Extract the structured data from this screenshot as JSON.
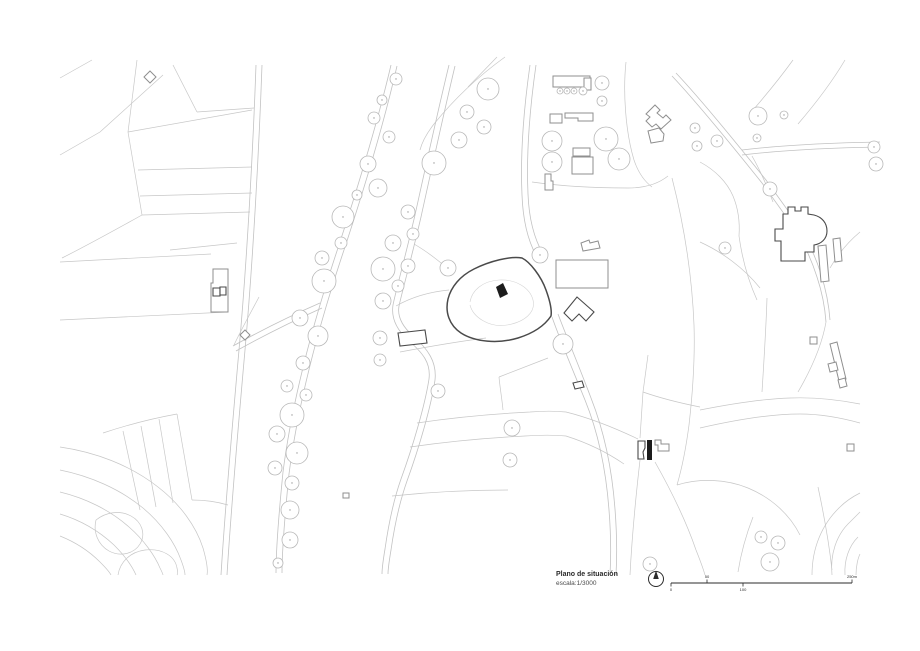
{
  "title_block": {
    "title": "Plano de situación",
    "scale": "escala:1/3000"
  },
  "scale_bar": {
    "x_start": 671,
    "x_end": 852,
    "y": 583,
    "ticks": [
      {
        "label": "0",
        "x": 671,
        "side": "below"
      },
      {
        "label": "50",
        "x": 707,
        "side": "above"
      },
      {
        "label": "100",
        "x": 743,
        "side": "below"
      },
      {
        "label": "250m",
        "x": 852,
        "side": "above"
      }
    ]
  },
  "north_arrow": {
    "cx": 656,
    "cy": 579,
    "r": 7.5
  },
  "colors": {
    "field_line": "#c7c7c7",
    "road": "#c2c2c2",
    "tree": "#b8b8b8",
    "tree_dot": "#9a9a9a",
    "building": "#8f8f8f",
    "dark": "#4a4a4a",
    "fill": "#1c1c1c",
    "ink": "#2b2b2b"
  },
  "map": {
    "field_lines": [
      "M 60 78 L 92 60",
      "M 60 155 L 100 132 L 163 75",
      "M 137 60 L 128 132",
      "M 128 132 L 252 110",
      "M 173 65 L 197 112",
      "M 197 112 L 254 108",
      "M 128 132 L 142 215",
      "M 138 170 L 252 167",
      "M 140 196 L 252 193",
      "M 142 215 L 250 212",
      "M 142 215 C 115 230 88 245 62 258",
      "M 60 262 L 211 254",
      "M 60 320 L 228 312",
      "M 170 250 L 237 243",
      "M 103 433 C 130 424 155 418 177 414",
      "M 177 414 L 192 500",
      "M 159 419 L 173 503",
      "M 141 426 L 156 507",
      "M 123 431 L 140 510",
      "M 192 500 C 206 500 218 502 228 505",
      "M 259 297 C 250 314 241 330 234 345",
      "M 505 57 C 480 75 455 98 434 124 C 427 133 422 142 420 150",
      "M 468 87 L 497 57",
      "M 532 182 C 560 186 595 188 628 188 C 645 188 658 184 668 176",
      "M 626 62 C 623 90 625 130 634 160 C 638 172 644 181 652 187",
      "M 672 178 C 684 225 692 275 694 325 C 695 355 693 390 689 425 C 686 448 682 468 677 485",
      "M 648 355 L 643 392 L 640 438",
      "M 643 392 C 660 398 680 403 700 407",
      "M 640 460 C 636 495 632 535 630 575",
      "M 655 462 C 668 485 684 515 696 550 C 700 560 703 568 705 575",
      "M 767 298 C 766 330 764 360 762 392",
      "M 700 410 C 730 404 760 399 790 398 C 815 397 840 400 860 404",
      "M 700 428 C 735 420 770 414 800 414 C 822 414 842 418 860 423",
      "M 826 322 C 822 345 812 368 798 392",
      "M 752 156 C 760 170 767 186 773 202",
      "M 700 162 C 715 170 727 182 733 196 C 738 208 740 222 739 236",
      "M 739 236 C 742 258 748 280 757 300",
      "M 700 242 C 722 252 744 268 760 288",
      "M 793 60 C 780 78 766 95 753 110",
      "M 845 60 C 832 82 816 103 798 124",
      "M 860 232 C 848 242 838 254 830 268",
      "M 417 423 C 450 418 490 414 530 412 C 542 411 556 411 566 412",
      "M 410 447 C 445 442 485 438 525 436 C 540 435 555 435 566 436",
      "M 392 496 C 430 492 470 490 508 490",
      "M 548 358 C 530 365 512 372 499 377",
      "M 499 377 C 500 388 502 399 503 410",
      "M 400 352 C 432 346 462 341 486 338",
      "M 566 412 C 590 418 615 428 638 439",
      "M 566 436 C 588 443 608 453 624 464",
      "M 449 290 C 428 292 410 298 396 306",
      "M 452 272 C 440 262 428 252 414 244",
      "M 677 485 C 700 478 726 479 748 488 C 772 498 790 515 800 535",
      "M 753 517 C 746 535 741 553 738 572",
      "M 818 487 C 824 515 829 543 832 570"
    ],
    "contours": [
      "M 60 447 C 95 452 130 465 158 487 C 180 504 196 526 203 548 C 207 562 208 570 207 575",
      "M 60 470 C 90 476 120 489 143 508 C 162 524 175 543 181 560 C 184 568 185 572 185 575",
      "M 60 492 C 85 498 110 510 129 527 C 144 540 155 556 160 568 C 162 572 163 574 163 575",
      "M 60 514 C 80 520 99 531 114 545 C 124 555 132 566 136 575",
      "M 60 536 C 75 542 89 551 100 562 C 105 567 109 571 111 575",
      "M 96 520 C 106 512 120 510 131 516 C 142 522 146 534 140 544 C 134 554 120 557 109 551 C 98 545 93 532 96 520",
      "M 118 575 C 120 562 130 552 145 550 C 162 548 175 556 177 568 C 178 572 178 574 177 575",
      "M 812 575 C 812 548 822 524 840 507 C 847 500 854 496 860 493",
      "M 832 575 C 830 555 836 535 850 522 C 855 517 858 514 860 512",
      "M 845 575 C 844 560 849 546 858 537",
      "M 856 575 C 856 566 858 558 860 554"
    ],
    "roads": [
      "M 256 65 C 253 150 247 260 239 350 C 231 440 225 510 221 575",
      "M 262 65 C 259 150 253 260 245 350 C 237 440 231 510 227 575",
      "M 391 65 C 380 112 360 182 335 257 C 312 327 292 402 283 472 C 278 522 276 550 276 573",
      "M 397 66 C 386 114 366 184 341 259 C 318 329 298 404 289 474 C 284 524 282 551 282 573",
      "M 449 65 C 438 110 426 165 415 215 C 404 262 396 290 393 305 C 391 318 397 330 408 340 C 423 353 431 363 429 379 C 425 405 413 446 401 479 C 395 496 389 521 385 549 C 383 561 382 569 382 574",
      "M 455 66 C 444 112 432 167 421 217 C 410 264 402 292 399 306 C 397 317 403 327 413 336 C 428 349 437 362 435 380 C 431 407 419 448 407 481 C 401 498 395 522 391 550 C 389 562 388 569 388 574",
      "M 530 65 C 525 100 520 150 522 195 C 523 222 529 243 537 257",
      "M 536 65 C 531 100 526 150 528 194 C 529 220 535 240 543 254",
      "M 552 317 C 560 340 572 368 585 400 C 598 432 606 470 609 510 C 611 535 611 557 610 575",
      "M 558 314 C 567 338 579 366 591 398 C 604 431 612 469 615 509 C 617 535 617 557 616 575",
      "M 672 76 C 690 95 726 138 762 183 L 790 222 C 800 236 810 255 817 277 C 822 292 825 308 826 322",
      "M 676 73 C 694 92 730 135 766 180 L 794 219 C 804 233 814 252 821 274 C 826 290 829 306 830 320",
      "M 742 150 C 775 146 820 143 880 142",
      "M 742 155 C 775 151 820 148 880 147",
      "M 233 346 C 260 331 290 316 320 303",
      "M 236 351 C 263 336 293 321 322 308"
    ],
    "buildings_gray": [
      "M 553 76 L 590 76 L 590 87 L 553 87 Z",
      "M 584 78 L 591 78 L 591 90 L 584 90 Z",
      "M 550 114 L 562 114 L 562 123 L 550 123 Z",
      "M 565 113 L 593 113 L 593 121 L 578 121 L 578 118 L 565 118 Z",
      "M 573 148 L 590 148 L 590 156 L 573 156 Z",
      "M 572 157 L 593 157 L 593 174 L 572 174 Z",
      "M 545 174 L 551 174 L 551 181 L 553 181 L 553 190 L 545 190 Z",
      "M 556 260 L 608 260 L 608 288 L 556 288 Z",
      "M 581 243 L 589 240 L 590 243 L 598 241 L 600 248 L 583 251 Z",
      "M 646 114 L 655 105 L 660 110 L 657 113 L 663 118 L 666 115 L 671 120 L 661 129 L 656 124 L 652 127 L 646 121 L 650 117 Z",
      "M 648 131 L 659 128 L 664 134 L 663 141 L 651 143 Z",
      "M 818 246 L 826 245 L 829 281 L 821 282 Z",
      "M 833 239 L 840 238 L 842 261 L 835 262 Z",
      "M 830 344 L 837 342 L 846 379 L 839 381 Z",
      "M 828 364 L 836 362 L 838 370 L 830 372 Z",
      "M 810 337 L 817 337 L 817 344 L 810 344 Z",
      "M 847 444 L 854 444 L 854 451 L 847 451 Z",
      "M 838 380 L 845 378 L 847 386 L 840 388 Z",
      "M 213 269 L 228 269 L 228 312 L 211 312 L 211 283 L 213 283 Z",
      "M 150 71 L 156 77 L 150 83 L 144 77 Z",
      "M 245 330 L 250 335 L 245 340 L 240 335 Z",
      "M 343 493 L 349 493 L 349 498 L 343 498 Z",
      "M 655 440 L 661 440 L 661 444 L 669 444 L 669 451 L 658 451 L 658 445 L 655 445 Z"
    ],
    "buildings_dark": [
      "M 788 207 L 795 207 L 795 211 L 801 211 L 801 207 L 808 207 L 808 214 L 814 215 C 822 217 827 223 827 231 C 827 239 821 244 814 245 L 814 252 L 805 252 L 805 261 L 781 261 L 781 241 L 775 241 L 775 229 L 783 229 L 783 214 L 788 214 Z",
      "M 398 333 L 425 330 L 427 343 L 400 346 Z",
      "M 573 383 L 582 381 L 584 387 L 575 389 Z",
      "M 577 297 L 594 312 L 586 321 L 579 314 L 572 321 L 564 313 Z",
      "M 638 441 L 645 441 L 645 448 L 643 452 L 644 459 L 638 459 Z",
      "M 213 288 L 220 288 L 220 296 L 213 296 Z",
      "M 220 287 L 226 287 L 226 295 L 220 295 Z"
    ],
    "dark_filled": [
      "M 647 440 L 652 440 L 652 460 L 647 460 Z"
    ],
    "site_boundary": "M 522 258 C 530 262 541 276 546 290 C 550 301 552 310 551 316 C 545 325 534 333 518 338 C 498 344 475 342 461 333 C 449 325 445 312 448 299 C 451 287 460 276 474 269 C 490 261 510 256 522 258 Z",
    "inner_contour": "M 470 302 C 472 290 483 281 499 280 C 516 279 530 288 533 300 C 536 312 525 322 507 325 C 489 328 473 317 470 305",
    "main_building": "M 496 287 L 503 283 L 508 294 L 500 298 Z",
    "trees": [
      [
        488,
        89,
        11
      ],
      [
        467,
        112,
        7
      ],
      [
        484,
        127,
        7
      ],
      [
        459,
        140,
        8
      ],
      [
        434,
        163,
        12
      ],
      [
        396,
        79,
        6
      ],
      [
        382,
        100,
        5
      ],
      [
        374,
        118,
        6
      ],
      [
        389,
        137,
        6
      ],
      [
        368,
        164,
        8
      ],
      [
        378,
        188,
        9
      ],
      [
        357,
        195,
        5
      ],
      [
        343,
        217,
        11
      ],
      [
        341,
        243,
        6
      ],
      [
        322,
        258,
        7
      ],
      [
        324,
        281,
        12
      ],
      [
        300,
        318,
        8
      ],
      [
        318,
        336,
        10
      ],
      [
        303,
        363,
        7
      ],
      [
        287,
        386,
        6
      ],
      [
        306,
        395,
        6
      ],
      [
        292,
        415,
        12
      ],
      [
        277,
        434,
        8
      ],
      [
        297,
        453,
        11
      ],
      [
        275,
        468,
        7
      ],
      [
        292,
        483,
        7
      ],
      [
        290,
        510,
        9
      ],
      [
        290,
        540,
        8
      ],
      [
        278,
        563,
        5
      ],
      [
        408,
        212,
        7
      ],
      [
        413,
        234,
        6
      ],
      [
        393,
        243,
        8
      ],
      [
        408,
        266,
        7
      ],
      [
        383,
        269,
        12
      ],
      [
        398,
        286,
        6
      ],
      [
        383,
        301,
        8
      ],
      [
        380,
        338,
        7
      ],
      [
        380,
        360,
        6
      ],
      [
        438,
        391,
        7
      ],
      [
        512,
        428,
        8
      ],
      [
        510,
        460,
        7
      ],
      [
        448,
        268,
        8
      ],
      [
        540,
        255,
        8
      ],
      [
        563,
        344,
        10
      ],
      [
        602,
        83,
        7
      ],
      [
        560,
        91,
        3
      ],
      [
        567,
        91,
        3
      ],
      [
        574,
        91,
        3
      ],
      [
        583,
        91,
        4
      ],
      [
        602,
        101,
        5
      ],
      [
        552,
        141,
        10
      ],
      [
        552,
        162,
        10
      ],
      [
        606,
        139,
        12
      ],
      [
        619,
        159,
        11
      ],
      [
        695,
        128,
        5
      ],
      [
        697,
        146,
        5
      ],
      [
        758,
        116,
        9
      ],
      [
        784,
        115,
        4
      ],
      [
        757,
        138,
        4
      ],
      [
        717,
        141,
        6
      ],
      [
        770,
        189,
        7
      ],
      [
        725,
        248,
        6
      ],
      [
        874,
        147,
        6
      ],
      [
        876,
        164,
        7
      ],
      [
        650,
        564,
        7
      ],
      [
        761,
        537,
        6
      ],
      [
        778,
        543,
        7
      ],
      [
        770,
        562,
        9
      ]
    ]
  }
}
